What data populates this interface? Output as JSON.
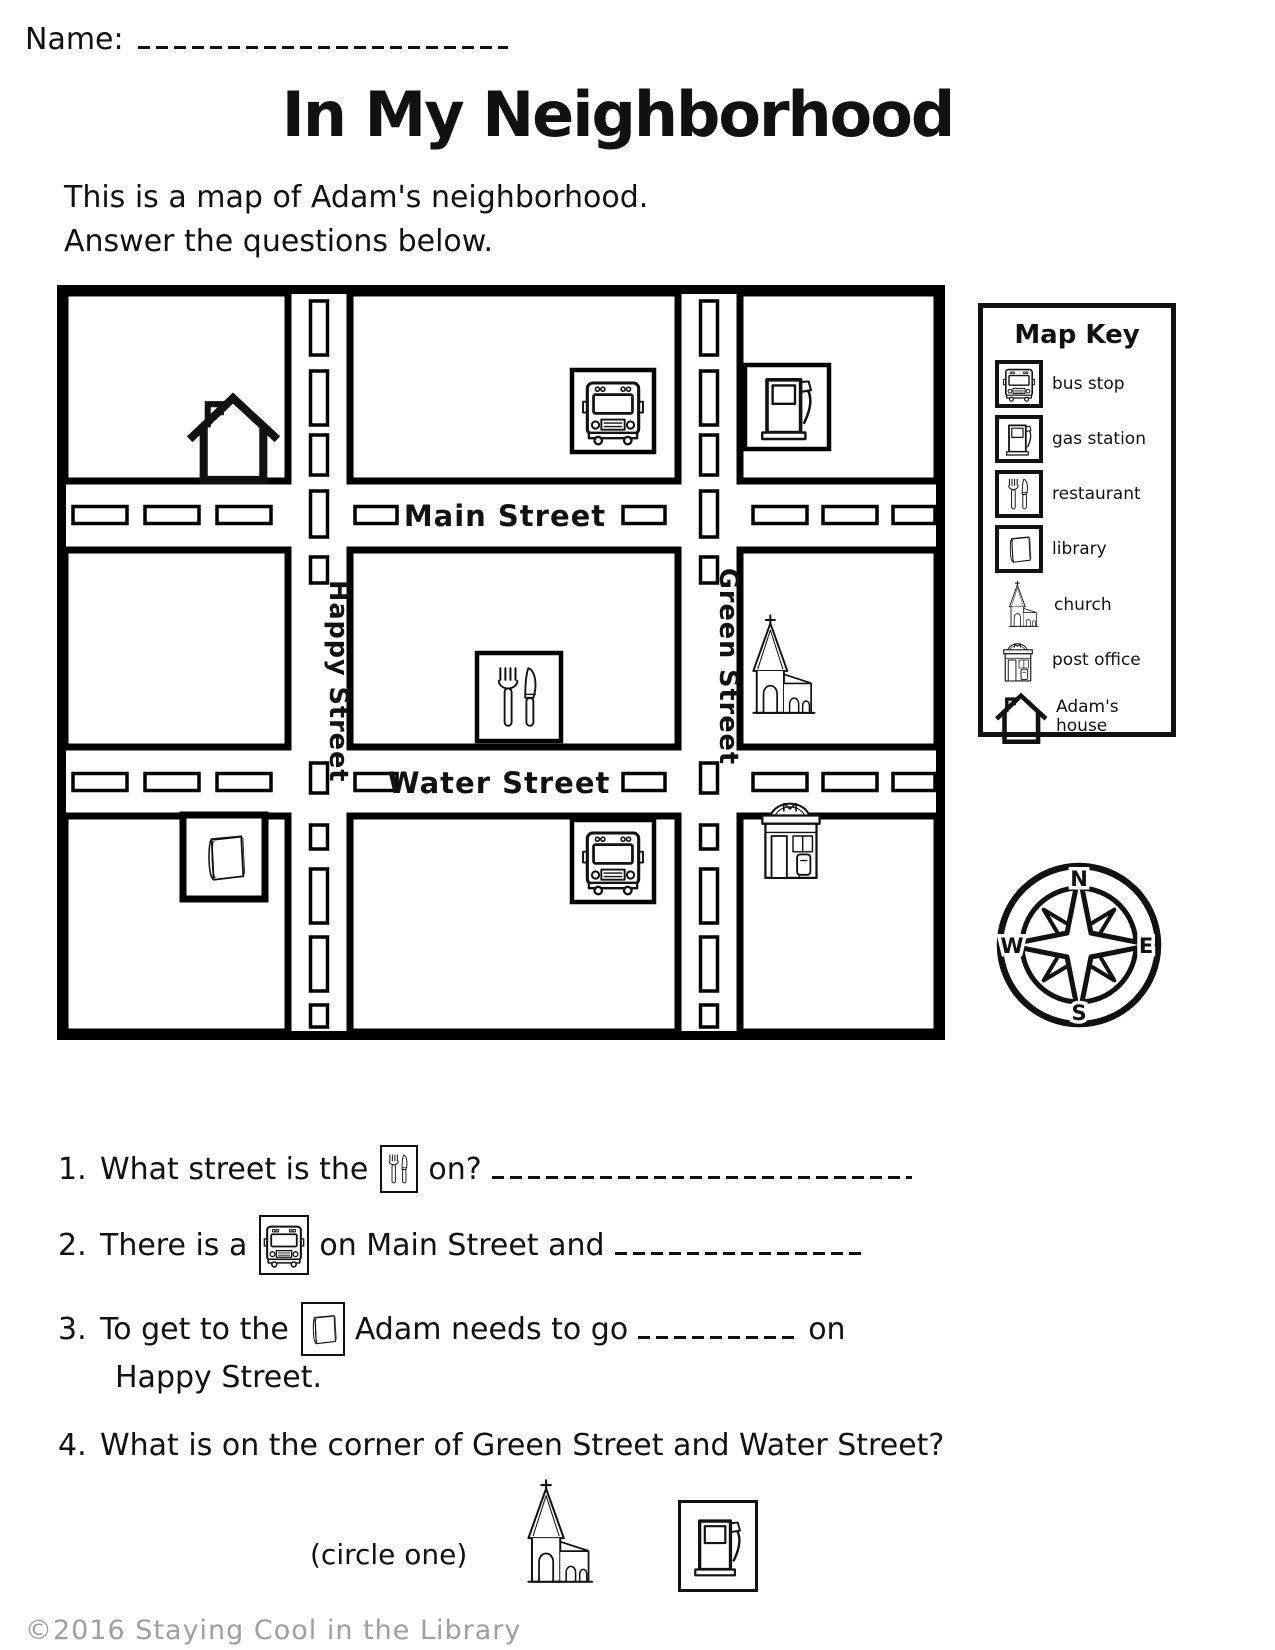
{
  "page": {
    "name_label": "Name:",
    "title": "In My Neighborhood",
    "intro_line1": "This is a map of Adam's neighborhood.",
    "intro_line2": "Answer the questions below.",
    "footer": "©2016 Staying Cool in the Library"
  },
  "map": {
    "streets": {
      "main": "Main Street",
      "water": "Water Street",
      "happy": "Happy Street",
      "green": "Green Street"
    },
    "locations": [
      {
        "block": "top-left",
        "icon": "house-icon",
        "name": "Adam's house"
      },
      {
        "block": "top-middle",
        "icon": "bus-icon",
        "name": "bus stop"
      },
      {
        "block": "top-right",
        "icon": "gas-pump-icon",
        "name": "gas station"
      },
      {
        "block": "center",
        "icon": "fork-knife-icon",
        "name": "restaurant"
      },
      {
        "block": "middle-right",
        "icon": "church-icon",
        "name": "church"
      },
      {
        "block": "bottom-left",
        "icon": "book-icon",
        "name": "library"
      },
      {
        "block": "bottom-middle",
        "icon": "bus-icon",
        "name": "bus stop"
      },
      {
        "block": "bottom-right",
        "icon": "post-office-icon",
        "name": "post office"
      }
    ]
  },
  "map_key": {
    "title": "Map Key",
    "entries": [
      {
        "icon": "bus-icon",
        "label": "bus stop"
      },
      {
        "icon": "gas-pump-icon",
        "label": "gas station"
      },
      {
        "icon": "fork-knife-icon",
        "label": "restaurant"
      },
      {
        "icon": "book-icon",
        "label": "library"
      },
      {
        "icon": "church-icon",
        "label": "church"
      },
      {
        "icon": "post-office-icon",
        "label": "post office"
      },
      {
        "icon": "house-icon",
        "label": "Adam's house"
      }
    ]
  },
  "compass": {
    "n": "N",
    "e": "E",
    "s": "S",
    "w": "W"
  },
  "questions": {
    "q1": {
      "number": "1.",
      "pre": "What street is the",
      "post": "on?"
    },
    "q2": {
      "number": "2.",
      "pre": "There is a",
      "post": "on Main Street and"
    },
    "q3": {
      "number": "3.",
      "pre": "To get to the",
      "mid": "Adam needs to go",
      "post": "on",
      "line2": "Happy Street."
    },
    "q4": {
      "number": "4.",
      "text": "What is on the corner of Green Street and Water Street?",
      "circle": "(circle one)"
    }
  }
}
